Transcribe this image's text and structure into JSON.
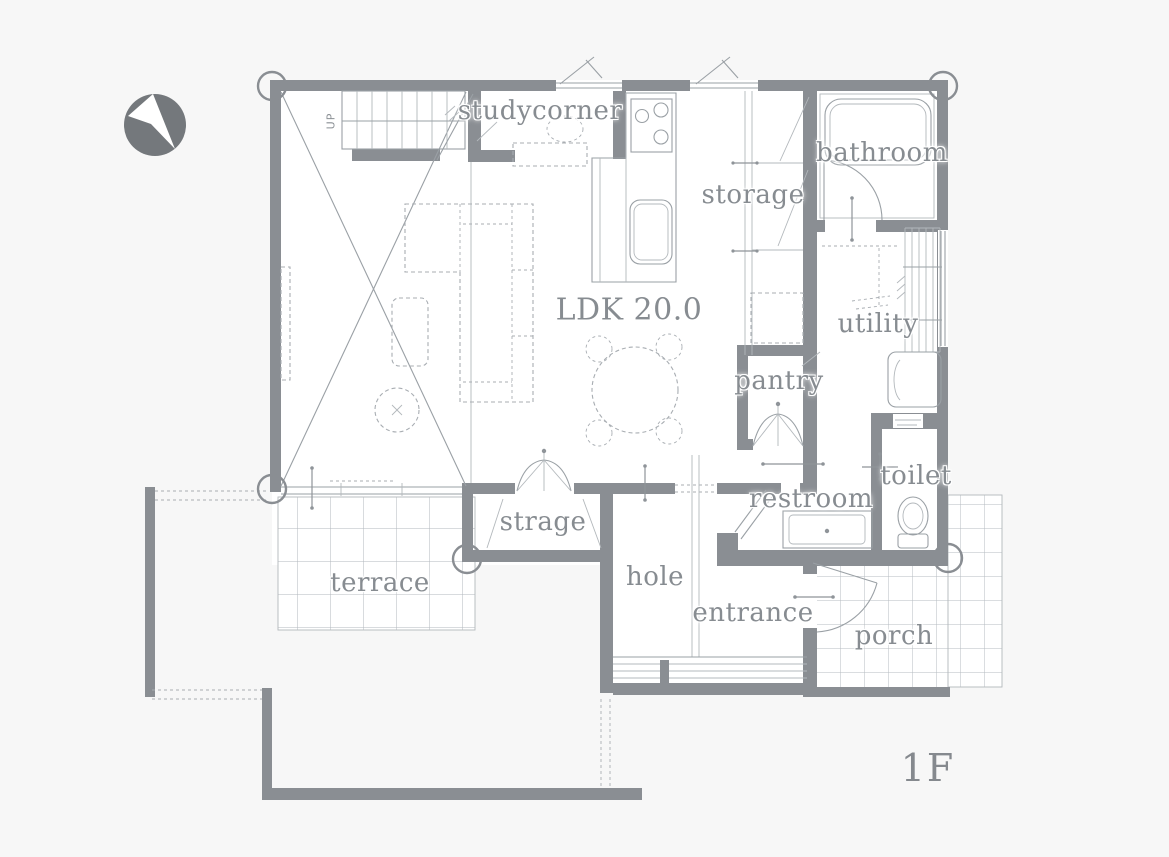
{
  "plan": {
    "floor_label": "1F",
    "stairs": {
      "direction_label": "UP"
    },
    "rooms": [
      {
        "id": "studycorner",
        "label": "studycorner"
      },
      {
        "id": "bathroom",
        "label": "bathroom"
      },
      {
        "id": "storage",
        "label": "storage"
      },
      {
        "id": "ldk",
        "label": "LDK 20.0"
      },
      {
        "id": "utility",
        "label": "utility"
      },
      {
        "id": "pantry",
        "label": "pantry"
      },
      {
        "id": "toilet",
        "label": "toilet"
      },
      {
        "id": "restroom",
        "label": "restroom"
      },
      {
        "id": "strage",
        "label": "strage"
      },
      {
        "id": "hole",
        "label": "hole"
      },
      {
        "id": "entrance",
        "label": "entrance"
      },
      {
        "id": "porch",
        "label": "porch"
      },
      {
        "id": "terrace",
        "label": "terrace"
      }
    ],
    "icons": {
      "compass": "north-arrow-icon"
    },
    "colors": {
      "wall": "#8a8e93",
      "line": "#9aa0a5",
      "text": "#878c91",
      "background": "#f7f7f7",
      "compass": "#74787c"
    }
  }
}
